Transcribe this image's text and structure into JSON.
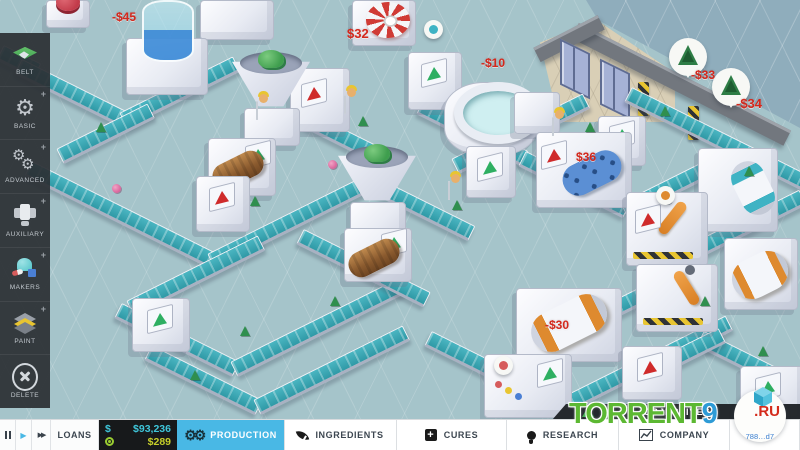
{
  "sidebar": {
    "items": [
      {
        "label": "BELT",
        "icon": "belt-icon"
      },
      {
        "label": "BASIC",
        "icon": "gear-icon",
        "plus": "+"
      },
      {
        "label": "ADVANCED",
        "icon": "gears-icon",
        "plus": "+"
      },
      {
        "label": "AUXILIARY",
        "icon": "auxiliary-machine-icon",
        "plus": "+"
      },
      {
        "label": "MAKERS",
        "icon": "maker-machine-icon",
        "plus": "+"
      },
      {
        "label": "PAINT",
        "icon": "paint-layers-icon",
        "plus": "+"
      },
      {
        "label": "DELETE",
        "icon": "delete-circle-icon"
      }
    ]
  },
  "map": {
    "price_labels": [
      {
        "text": "-$45"
      },
      {
        "text": "$32"
      },
      {
        "text": "-$10"
      },
      {
        "text": "-$33"
      },
      {
        "text": "-$34"
      },
      {
        "text": "$36"
      },
      {
        "text": "-$30"
      }
    ],
    "ingredient_bubbles": [
      {
        "item": "green-ingredient"
      },
      {
        "item": "green-ingredient"
      }
    ]
  },
  "hud": {
    "playback": {
      "play_icon": "▶",
      "fast_forward_icon": "▶▶"
    },
    "loans_label": "LOANS",
    "money": {
      "symbol": "$",
      "balance": "$93,236",
      "income": "$289"
    },
    "tabs": [
      {
        "label": "PRODUCTION",
        "active": true
      },
      {
        "label": "INGREDIENTS"
      },
      {
        "label": "CURES"
      },
      {
        "label": "RESEARCH"
      },
      {
        "label": "COMPANY"
      }
    ],
    "objectives_label": "OBJECTIVES"
  },
  "watermark": {
    "name": "TORRENT",
    "nine": "9",
    "tld": ".RU",
    "code": "788…d7"
  },
  "colors": {
    "accent": "#49b8e5",
    "money": "#3fc6da",
    "income": "#c6cf2a",
    "price": "#d4281c",
    "belt": "#3fb3c4"
  }
}
